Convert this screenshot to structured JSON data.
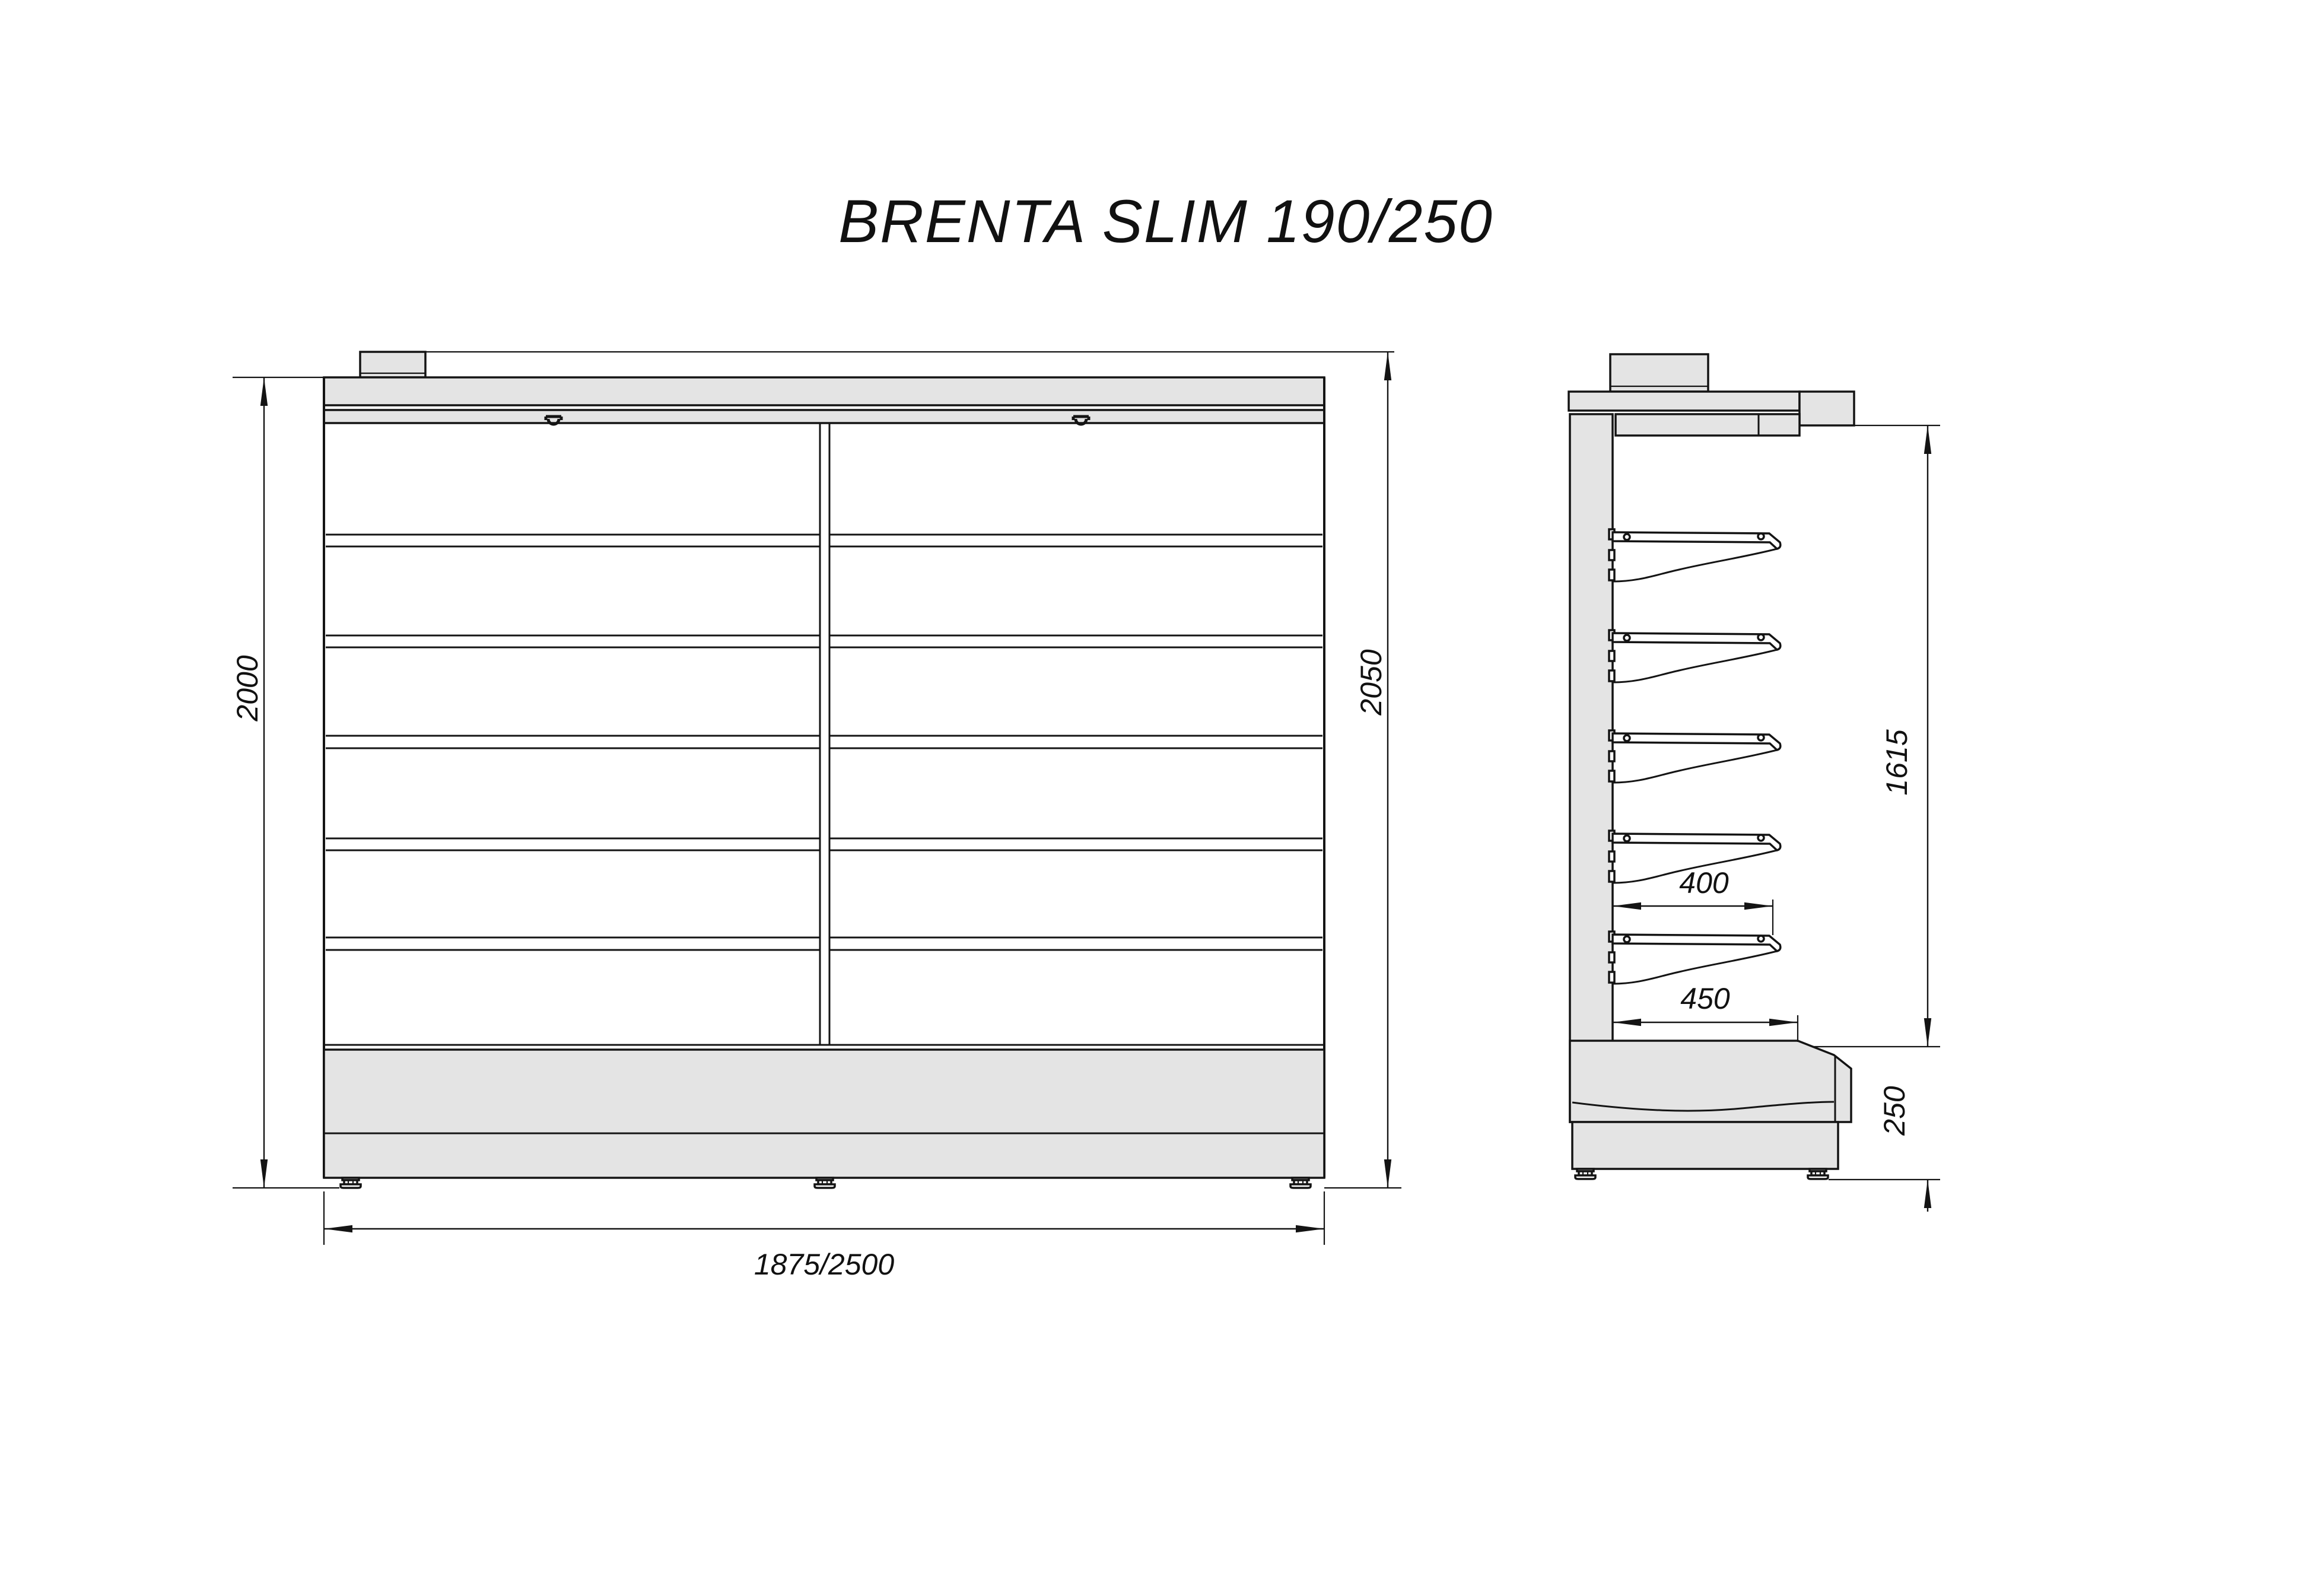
{
  "title": "BRENTA SLIM 190/250",
  "front_view": {
    "dimensions": {
      "height_left": "2000",
      "height_right": "2050",
      "width_bottom": "1875/2500"
    }
  },
  "side_view": {
    "dimensions": {
      "shelf_depth": "400",
      "base_depth": "450",
      "upper_height": "1615",
      "base_height": "250"
    }
  },
  "icons": {
    "canopy_hook": "hook-icon"
  },
  "colors": {
    "panel_fill": "#e4e4e4",
    "line": "#141414",
    "background": "#ffffff"
  }
}
